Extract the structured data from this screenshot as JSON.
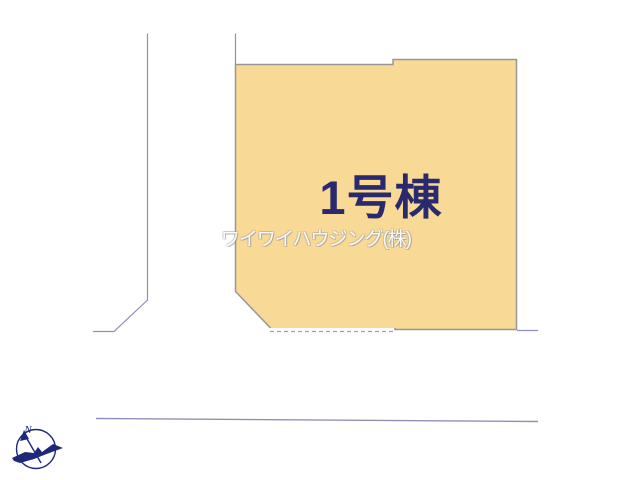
{
  "plan": {
    "lot": {
      "label": "1号棟",
      "fill_color": "#f8d995",
      "outline_color": "#979797",
      "label_color": "#29296d"
    },
    "watermark": {
      "text": "ワイワイハウジング(株)"
    },
    "compass": {
      "north_label": "N",
      "color": "#1e2878"
    },
    "road_color": "#8f8fbc",
    "setback_dash_color": "#a0a0a0",
    "background_color": "#ffffff"
  }
}
